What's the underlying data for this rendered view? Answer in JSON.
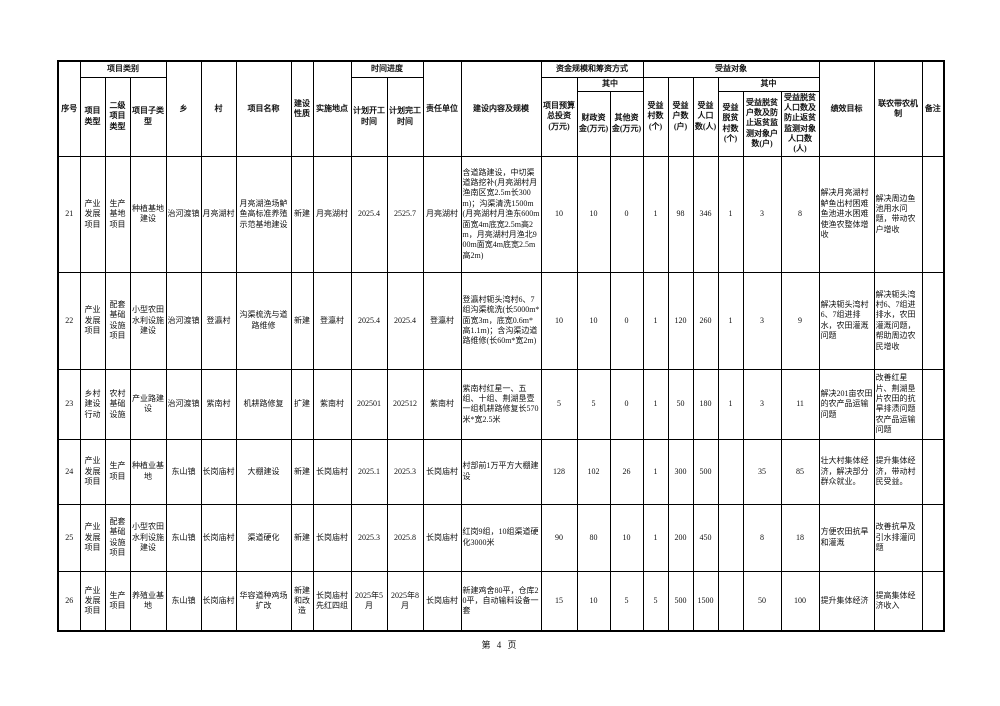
{
  "page": {
    "footer": "第 4 页"
  },
  "table": {
    "header": {
      "seq": "序号",
      "category_group": "项目类别",
      "project_type": "项目类型",
      "secondary_type": "二级项目类型",
      "sub_type": "项目子类型",
      "township": "乡",
      "village": "村",
      "project_name": "项目名称",
      "construction_nature": "建设性质",
      "implementation_site": "实施地点",
      "time_progress_group": "时间进度",
      "planned_start": "计划开工时间",
      "planned_finish": "计划完工时间",
      "responsible_unit": "责任单位",
      "content_scale": "建设内容及规模",
      "funding_group": "资金规模和筹资方式",
      "total_budget": "项目预算总投资(万元)",
      "among_funds": "其中",
      "fiscal_funds": "财政资金(万元)",
      "other_funds": "其他资金(万元)",
      "beneficiary_group": "受益对象",
      "beneficiary_villages": "受益村数(个)",
      "beneficiary_households": "受益户数(户)",
      "beneficiary_population": "受益人口数(人)",
      "among_beneficiary": "其中",
      "poverty_villages": "受益脱贫村数(个)",
      "poverty_households": "受益脱贫户数及防止返贫监测对象户数(户)",
      "poverty_population": "受益脱贫人口数及防止返贫监测对象人口数(人)",
      "performance_goal": "绩效目标",
      "farmer_linkage": "联农带农机制",
      "remarks": "备注"
    },
    "rows": [
      [
        "21",
        "产业发展项目",
        "生产基地项目",
        "种植基地建设",
        "治河渡镇",
        "月亮湖村",
        "月亮湖渔场鲈鱼高标准养殖示范基地建设",
        "新建",
        "月亮湖村",
        "2025.4",
        "2525.7",
        "月亮湖村",
        "含道路建设，中切渠道路挖补(月亮湖村月渔南区宽2.5m长300m)；沟渠清洗1500m(月亮湖村月渔东600m面宽4m底宽2.5m高2m，月亮湖村月渔北900m面宽4m底宽2.5m高2m)",
        "10",
        "10",
        "0",
        "1",
        "98",
        "346",
        "1",
        "3",
        "8",
        "解决月亮湖村鲈鱼出村困难鱼池进水困难使渔农整体增收",
        "解决周边鱼池用水问题，带动农户增收",
        ""
      ],
      [
        "22",
        "产业发展项目",
        "配套基础设施项目",
        "小型农田水利设施建设",
        "治河渡镇",
        "登瀛村",
        "沟渠梳洗与道路维修",
        "新建",
        "登瀛村",
        "2025.4",
        "2025.4",
        "登瀛村",
        "登瀛村轭头湾村6、7组沟渠梳洗(长5000m*面宽3m，底宽0.6m*高1.1m)；含沟渠边道路维修(长60m*宽2m)",
        "10",
        "10",
        "0",
        "1",
        "120",
        "260",
        "1",
        "3",
        "9",
        "解决轭头湾村6、7组进排水，农田灌溉问题",
        "解决轭头湾村6、7组进排水，农田灌溉问题，帮助周边农民增收",
        ""
      ],
      [
        "23",
        "乡村建设行动",
        "农村基础设施",
        "产业路建设",
        "治河渡镇",
        "紫南村",
        "机耕路修复",
        "扩建",
        "紫南村",
        "202501",
        "202512",
        "紫南村",
        "紫南村红星一、五组、十组、荆湖垦壹一组机耕路修复长570米*宽2.5米",
        "5",
        "5",
        "0",
        "1",
        "50",
        "180",
        "1",
        "3",
        "11",
        "解决201亩农田的农产品运输问题",
        "改善红星片、荆湖垦片农田的抗旱排渍问题农产品运输问题",
        ""
      ],
      [
        "24",
        "产业发展项目",
        "生产项目",
        "种植业基地",
        "东山镇",
        "长岗庙村",
        "大棚建设",
        "新建",
        "长岗庙村",
        "2025.1",
        "2025.3",
        "长岗庙村",
        "村部前1万平方大棚建设",
        "128",
        "102",
        "26",
        "1",
        "300",
        "500",
        "",
        "35",
        "85",
        "壮大村集体经济，解决部分群众就业。",
        "提升集体经济，带动村民受益。",
        ""
      ],
      [
        "25",
        "产业发展项目",
        "配套基础设施项目",
        "小型农田水利设施建设",
        "东山镇",
        "长岗庙村",
        "渠道硬化",
        "新建",
        "长岗庙村",
        "2025.3",
        "2025.8",
        "长岗庙村",
        "红岗9组，10组渠道硬化3000米",
        "90",
        "80",
        "10",
        "1",
        "200",
        "450",
        "",
        "8",
        "18",
        "方便农田抗旱和灌溉",
        "改善抗旱及引水排灌问题",
        ""
      ],
      [
        "26",
        "产业发展项目",
        "生产项目",
        "养殖业基地",
        "东山镇",
        "长岗庙村",
        "华容道种鸡场扩改",
        "新建和改造",
        "长岗庙村先红四组",
        "2025年5月",
        "2025年8月",
        "长岗庙村",
        "新建鸡舍80平，仓库20平，自动输料设备一套",
        "15",
        "10",
        "5",
        "5",
        "500",
        "1500",
        "",
        "50",
        "100",
        "提升集体经济",
        "提高集体经济收入",
        ""
      ]
    ]
  }
}
